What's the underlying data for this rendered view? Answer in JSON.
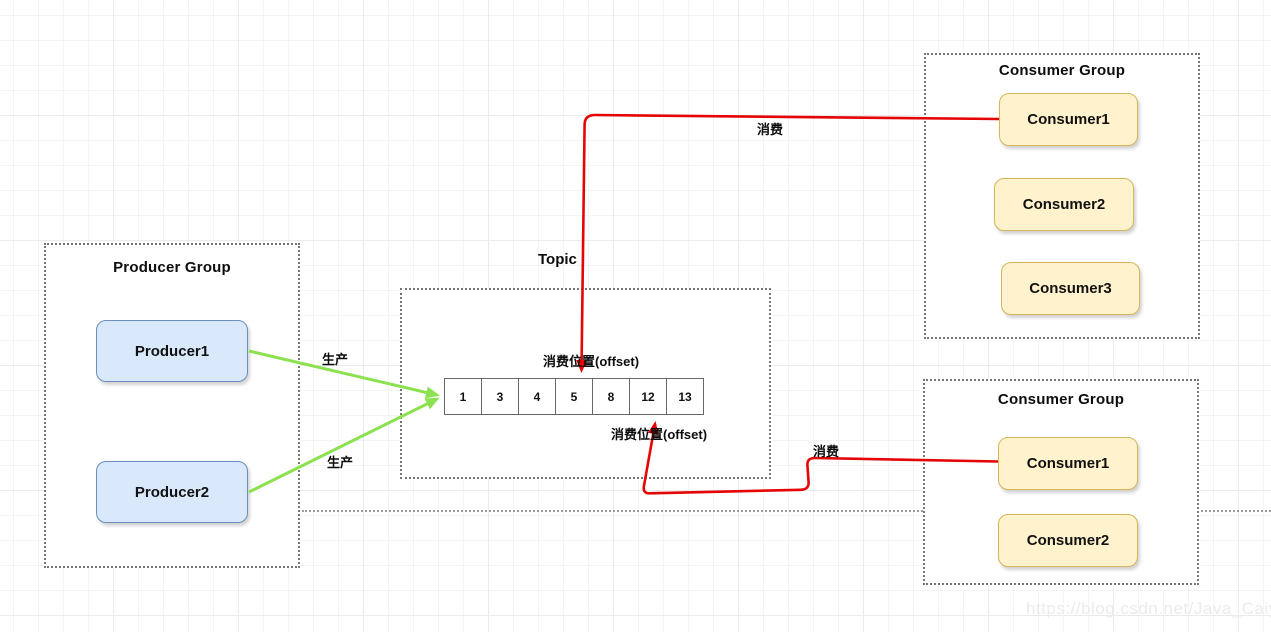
{
  "diagram": {
    "producer_group": {
      "title": "Producer Group",
      "producers": [
        "Producer1",
        "Producer2"
      ]
    },
    "topic": {
      "label": "Topic",
      "queue_cells": [
        "1",
        "3",
        "4",
        "5",
        "8",
        "12",
        "13"
      ],
      "offset_top_label": "消费位置(offset)",
      "offset_bottom_label": "消费位置(offset)"
    },
    "consumer_group_top": {
      "title": "Consumer Group",
      "consumers": [
        "Consumer1",
        "Consumer2",
        "Consumer3"
      ]
    },
    "consumer_group_bottom": {
      "title": "Consumer Group",
      "consumers": [
        "Consumer1",
        "Consumer2"
      ]
    },
    "edge_labels": {
      "produce_top": "生产",
      "produce_bottom": "生产",
      "consume_top": "消费",
      "consume_bottom": "消费"
    },
    "colors": {
      "producer_fill": "#dae8fc",
      "producer_border": "#6c8ebf",
      "consumer_fill": "#fff2cc",
      "consumer_border": "#d6b656",
      "produce_arrow_green": "#8ce14f",
      "consume_arrow_red": "#e60505",
      "dashed_border_gray": "#757575"
    }
  },
  "watermark": "https://blog.csdn.net/Java_Caiyo"
}
